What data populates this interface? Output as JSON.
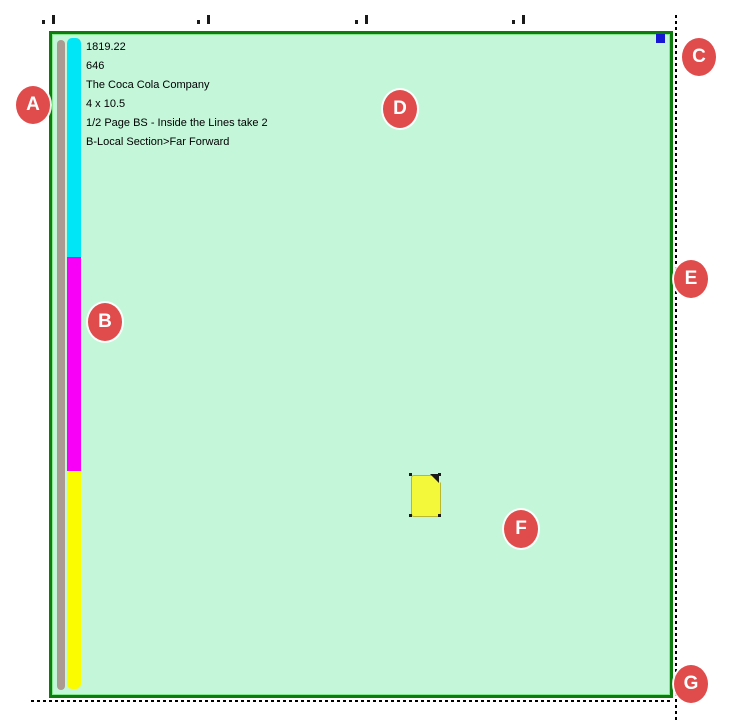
{
  "page": {
    "ad_info": {
      "lines": [
        "1819.22",
        "646",
        "The Coca Cola Company",
        "4 x 10.5",
        "1/2 Page BS - Inside the Lines take 2",
        "B-Local Section>Far Forward"
      ]
    },
    "colors": {
      "page_fill": "#c4f6da",
      "page_border": "#0e7b0e",
      "spine_bar": "#ab9a92",
      "segment_cyan": "#00e6f6",
      "segment_magenta": "#f800f8",
      "segment_yellow": "#fcfc00",
      "note_fill": "#f3f83a",
      "selection_handle": "#1717d4",
      "callout_red": "#e04b4b"
    }
  },
  "callouts": [
    {
      "label": "A"
    },
    {
      "label": "B"
    },
    {
      "label": "C"
    },
    {
      "label": "D"
    },
    {
      "label": "E"
    },
    {
      "label": "F"
    },
    {
      "label": "G"
    }
  ]
}
